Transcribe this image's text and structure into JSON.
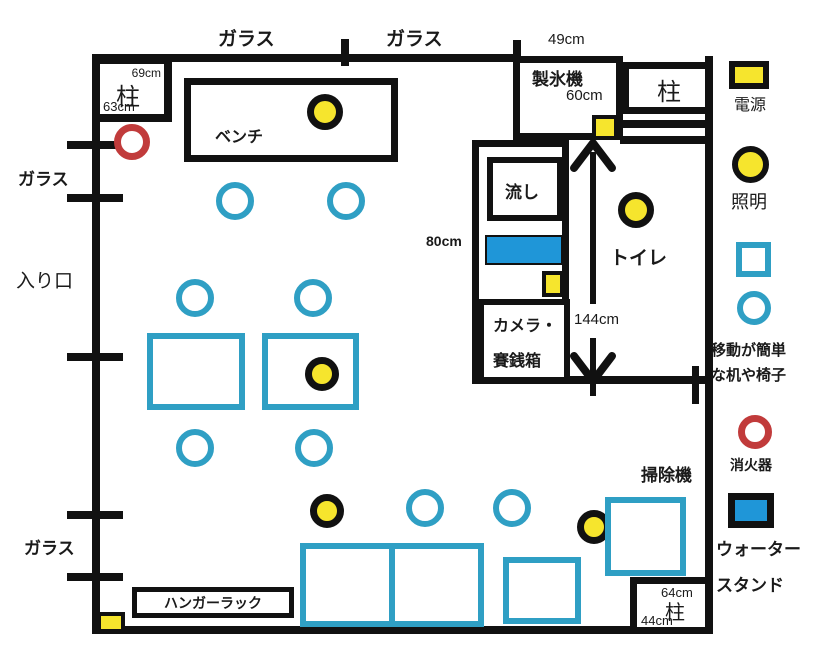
{
  "canvas": {
    "width": 813,
    "height": 666
  },
  "colors": {
    "wall": "#111111",
    "movable_blue_outline": "#2f9fc4",
    "water_blue_fill": "#1f96d8",
    "light_yellow": "#f6e52d",
    "fire_red": "#c13b3b"
  },
  "labels": {
    "glass_top_1": "ガラス",
    "glass_top_2": "ガラス",
    "glass_left_upper": "ガラス",
    "entrance": "入り口",
    "glass_left_lower": "ガラス",
    "dim_49": "49cm",
    "dim_60": "60cm",
    "dim_69": "69cm",
    "dim_63": "63cm",
    "dim_80": "80cm",
    "dim_144": "144cm",
    "dim_64": "64cm",
    "dim_44": "44cm"
  },
  "rooms": {
    "pillar_tl": "柱",
    "pillar_tr": "柱",
    "pillar_br": "柱",
    "bench": "ベンチ",
    "ice_maker": "製氷機",
    "sink": "流し",
    "camera_line1": "カメラ・",
    "camera_line2": "賽銭箱",
    "toilet": "トイレ",
    "vacuum": "掃除機",
    "hanger_rack": "ハンガーラック"
  },
  "legend": {
    "power": "電源",
    "light": "照明",
    "movable_line1": "移動が簡単",
    "movable_line2": "な机や椅子",
    "fire_extinguisher": "消火器",
    "water_stand_line1": "ウォーター",
    "water_stand_line2": "スタンド"
  }
}
